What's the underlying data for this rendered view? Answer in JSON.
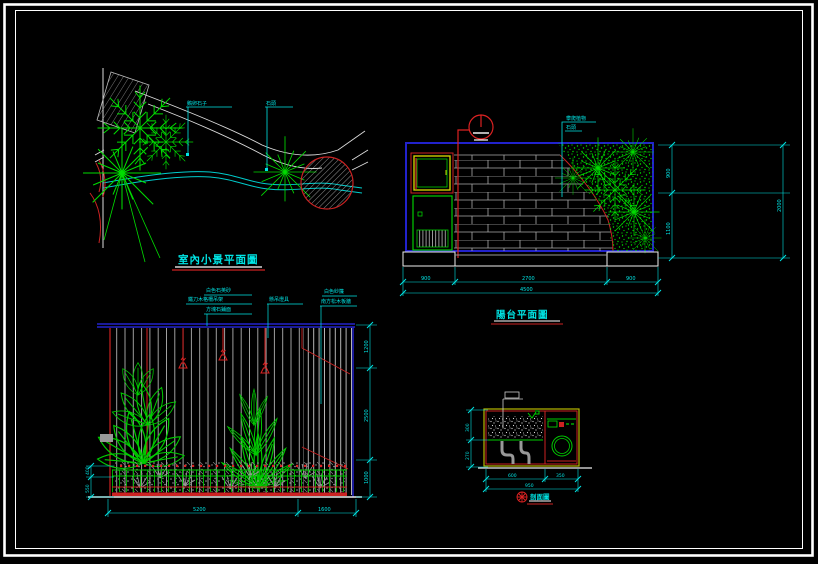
{
  "drawing": {
    "background": "#000000",
    "frame_color": "#ffffff",
    "accent_colors": {
      "plant_green": "#00dd00",
      "dim_cyan": "#00e5e5",
      "border_blue": "#2222cc",
      "line_red": "#cc2222",
      "brick_gray": "#aaaaaa",
      "cabinet_yellow": "#cccc00"
    }
  },
  "views": {
    "plan": {
      "title": "室內小景平面圖",
      "leaders": {
        "pebbles": "鵝卵石子",
        "stone": "石頭"
      }
    },
    "balcony": {
      "title": "陽台平面圖",
      "leaders": {
        "plants": "攀爬植物",
        "stone": "石頭"
      },
      "dims": {
        "bottom_segments": [
          "900",
          "2700",
          "900"
        ],
        "bottom_total": "4500",
        "right_segments": [
          "900",
          "1100"
        ],
        "right_total": "2000"
      }
    },
    "wall": {
      "leaders": [
        "白色石英砂",
        "鐵刀木格柵吊架",
        "方塊石鋪面",
        "懸吊燈具",
        "白色紗簾",
        "南方松木板牆"
      ],
      "dims": {
        "bottom_segments": [
          "5200",
          "1600"
        ],
        "right_segments": [
          "1200",
          "2500",
          "1000"
        ],
        "left_segments": [
          "400",
          "550"
        ]
      }
    },
    "section": {
      "title": "剖面圖",
      "dims": {
        "left_segments": [
          "300",
          "270"
        ],
        "bottom_segments": [
          "600",
          "350"
        ],
        "bottom_total": "950"
      }
    }
  }
}
